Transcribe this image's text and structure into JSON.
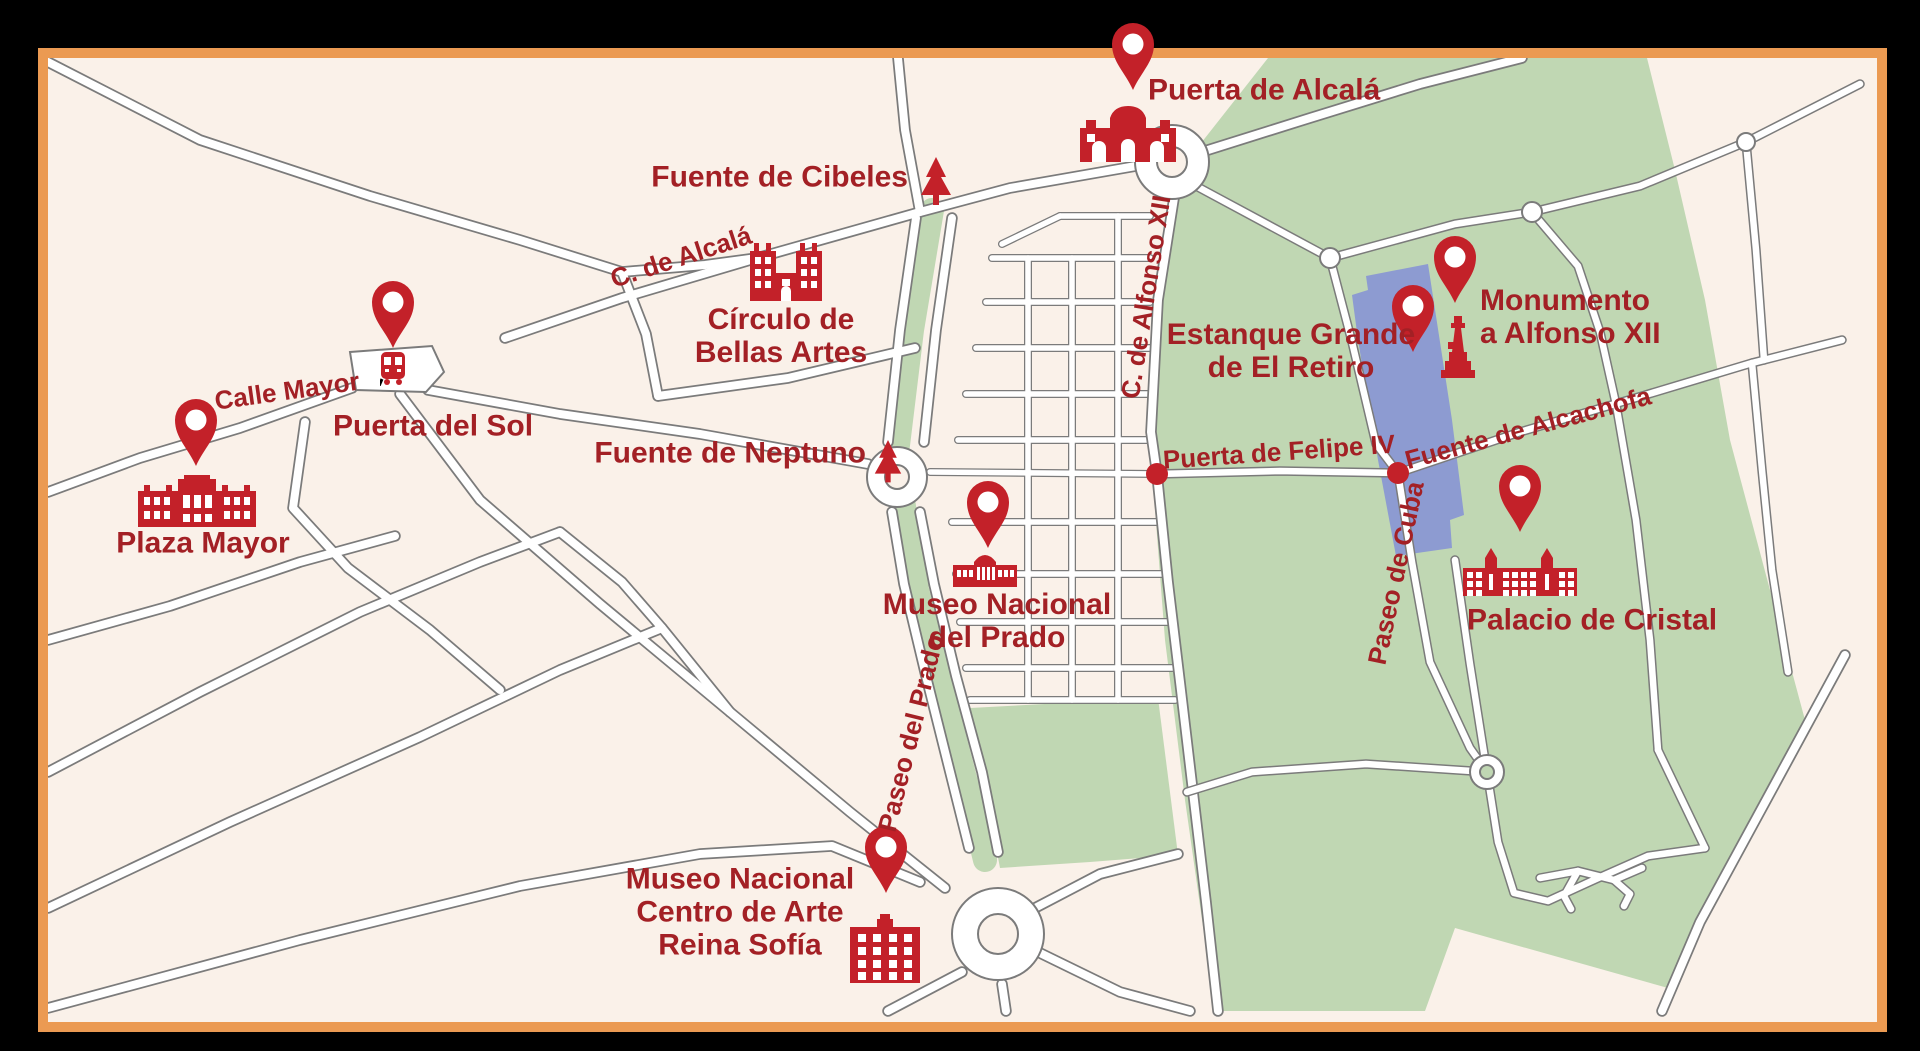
{
  "map": {
    "title": "Madrid city-centre landmarks map"
  },
  "colors": {
    "background": "#faf1e9",
    "park": "#c0d7b3",
    "water": "#8d9bd1",
    "road_outline": "#7b7b7b",
    "road_fill": "#ffffff",
    "marker_red": "#c32129",
    "label_red": "#a32025",
    "border_orange": "#eb9a52",
    "frame_black": "#000000"
  },
  "pois": [
    {
      "id": "puerta-de-alcala",
      "lines": [
        "Puerta de Alcalá"
      ]
    },
    {
      "id": "fuente-de-cibeles",
      "lines": [
        "Fuente de Cibeles"
      ]
    },
    {
      "id": "circulo-de-bellas-artes",
      "lines": [
        "Círculo de",
        "Bellas Artes"
      ]
    },
    {
      "id": "puerta-del-sol",
      "lines": [
        "Puerta del Sol"
      ]
    },
    {
      "id": "plaza-mayor",
      "lines": [
        "Plaza Mayor"
      ]
    },
    {
      "id": "fuente-de-neptuno",
      "lines": [
        "Fuente de Neptuno"
      ]
    },
    {
      "id": "museo-nacional-del-prado",
      "lines": [
        "Museo Nacional",
        "del Prado"
      ]
    },
    {
      "id": "museo-reina-sofia",
      "lines": [
        "Museo Nacional",
        "Centro de Arte",
        "Reina Sofía"
      ]
    },
    {
      "id": "estanque-grande",
      "lines": [
        "Estanque Grande",
        "de El Retiro"
      ]
    },
    {
      "id": "monumento-a-alfonso-xii",
      "lines": [
        "Monumento",
        "a Alfonso XII"
      ]
    },
    {
      "id": "palacio-de-cristal",
      "lines": [
        "Palacio de Cristal"
      ]
    }
  ],
  "streets": [
    {
      "id": "calle-mayor",
      "name": "Calle Mayor"
    },
    {
      "id": "c-de-alcala",
      "name": "C. de Alcalá"
    },
    {
      "id": "c-de-alfonso-xii",
      "name": "C. de Alfonso XII"
    },
    {
      "id": "paseo-del-prado",
      "name": "Paseo del Prado"
    },
    {
      "id": "puerta-de-felipe-iv",
      "name": "Puerta de Felipe IV"
    },
    {
      "id": "fuente-de-alcachofa",
      "name": "Fuente de Alcachofa"
    },
    {
      "id": "paseo-de-cuba",
      "name": "Paseo de Cuba"
    }
  ]
}
